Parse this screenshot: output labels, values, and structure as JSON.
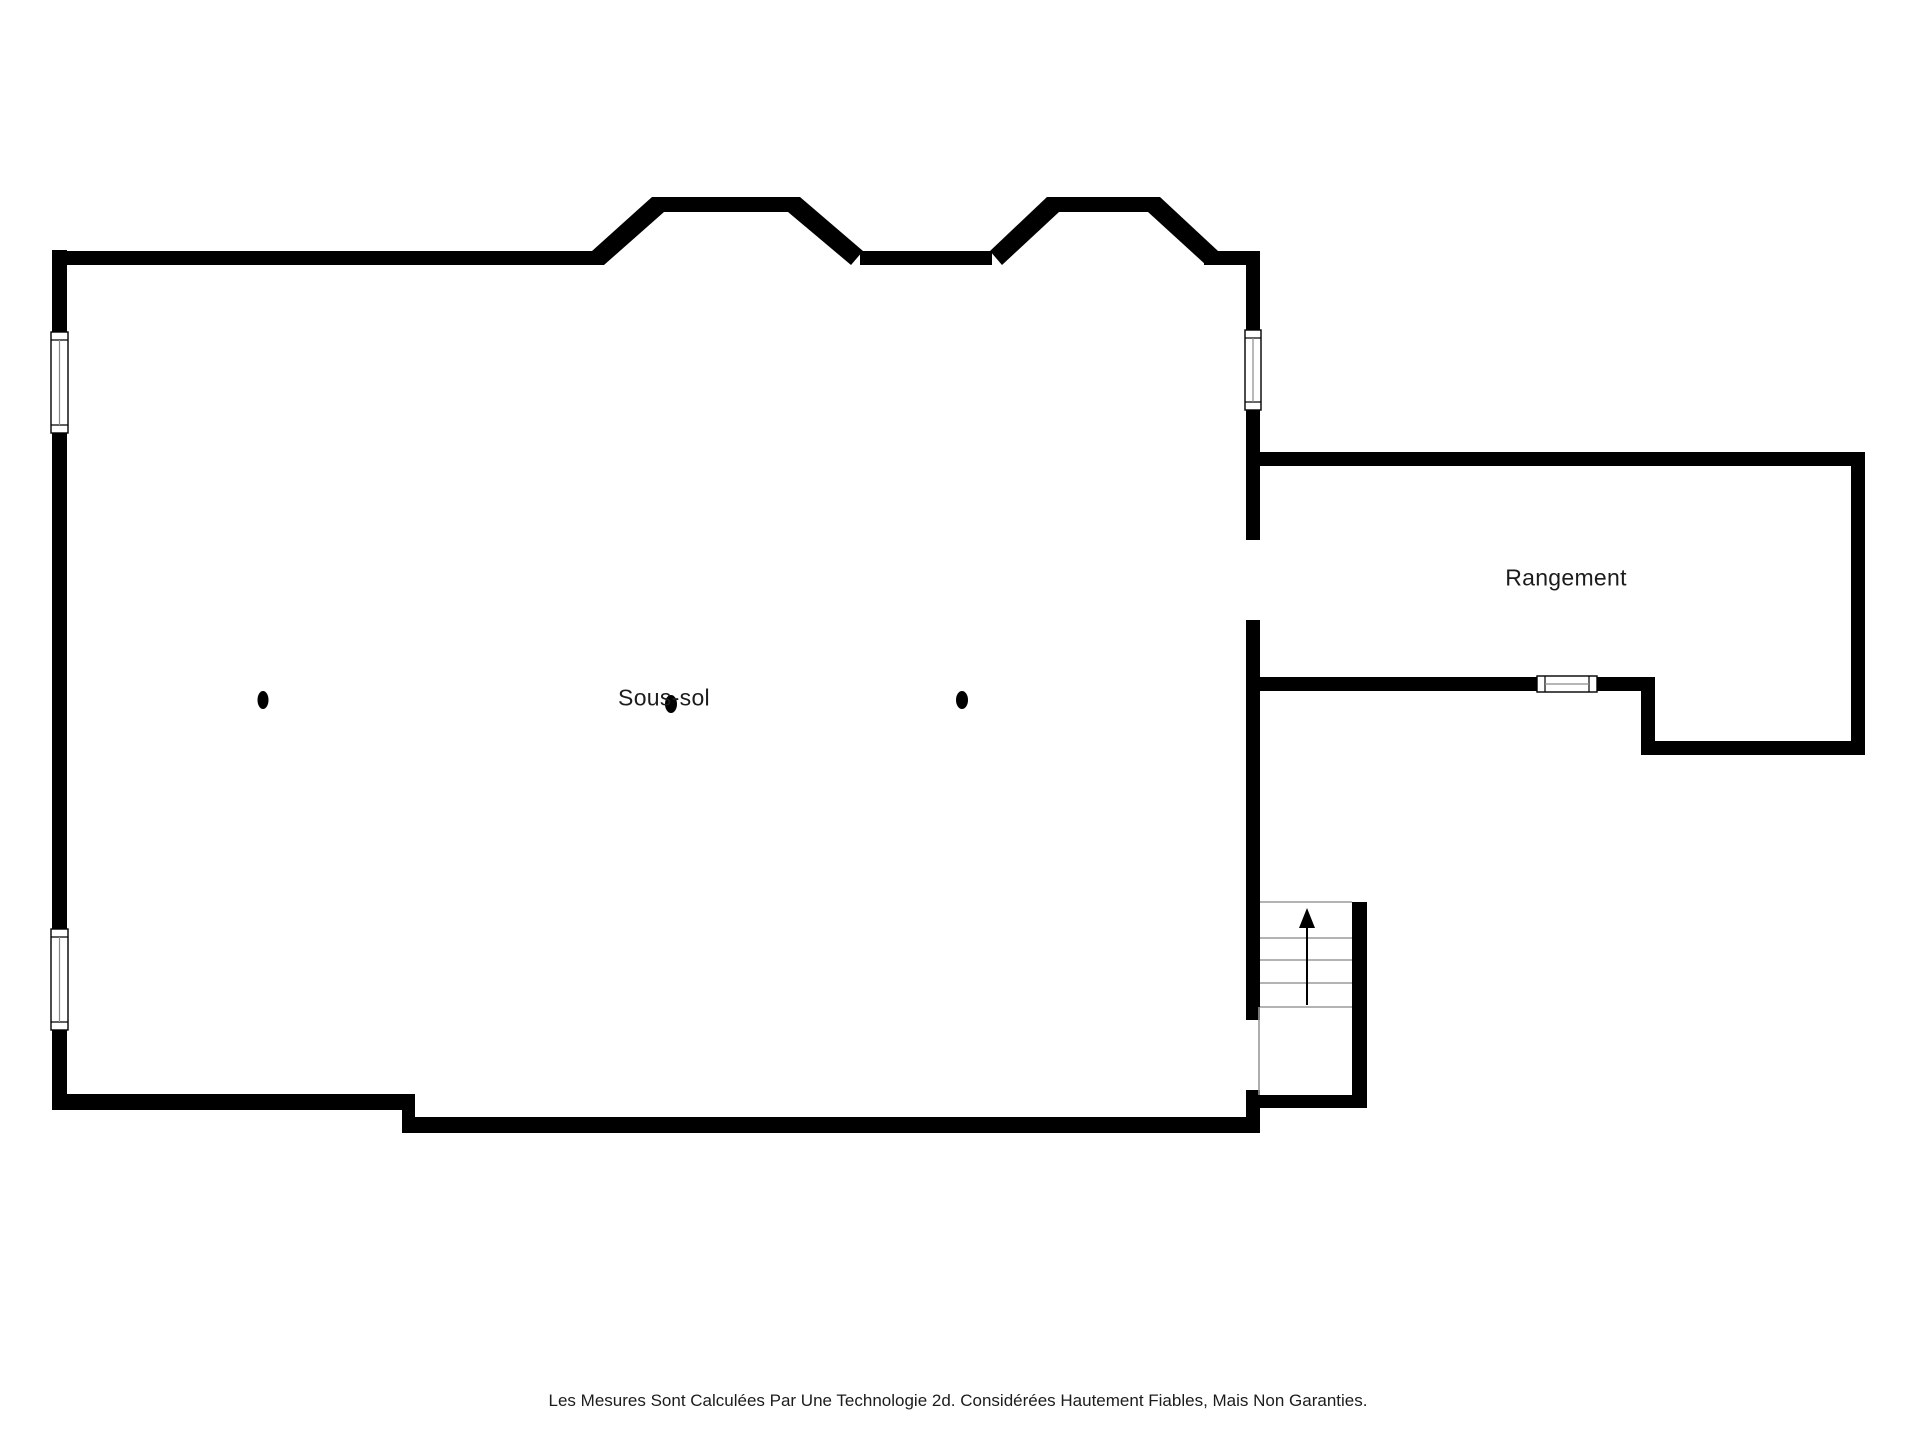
{
  "floorplan": {
    "canvas": {
      "width": 1920,
      "height": 1440
    },
    "colors": {
      "background": "#ffffff",
      "wall": "#000000",
      "thin_line": "#9a9a9a",
      "window_frame": "#000000",
      "window_mullion": "#8a8a8a",
      "text": "#1c1c1c"
    },
    "rooms": [
      {
        "id": "sous_sol",
        "label": "Sous-sol",
        "label_x": 664,
        "label_y": 698
      },
      {
        "id": "rangement",
        "label": "Rangement",
        "label_x": 1566,
        "label_y": 578
      }
    ],
    "footer": {
      "text": "Les Mesures Sont Calculées Par Une Technologie 2d. Considérées Hautement Fiables, Mais Non Garanties.",
      "x": 958,
      "y": 1401
    },
    "walls_rects": [
      {
        "name": "left-wall",
        "x": 52,
        "y": 250,
        "w": 15,
        "h": 860
      },
      {
        "name": "top-wall-west",
        "x": 52,
        "y": 251,
        "w": 552,
        "h": 14
      },
      {
        "name": "bay1-top-wall",
        "x": 652,
        "y": 197,
        "w": 148,
        "h": 15
      },
      {
        "name": "top-wall-mid",
        "x": 860,
        "y": 251,
        "w": 132,
        "h": 14
      },
      {
        "name": "bay2-top-wall",
        "x": 1047,
        "y": 197,
        "w": 113,
        "h": 15
      },
      {
        "name": "top-wall-east",
        "x": 1204,
        "y": 251,
        "w": 56,
        "h": 14
      },
      {
        "name": "right-wall-upper",
        "x": 1246,
        "y": 251,
        "w": 14,
        "h": 81
      },
      {
        "name": "right-wall-mid",
        "x": 1246,
        "y": 408,
        "w": 14,
        "h": 132
      },
      {
        "name": "right-wall-lower",
        "x": 1246,
        "y": 620,
        "w": 14,
        "h": 400
      },
      {
        "name": "right-wall-foot",
        "x": 1246,
        "y": 1090,
        "w": 14,
        "h": 43
      },
      {
        "name": "bottom-wall-center",
        "x": 402,
        "y": 1117,
        "w": 858,
        "h": 16
      },
      {
        "name": "bottom-wall-left",
        "x": 52,
        "y": 1094,
        "w": 363,
        "h": 16
      },
      {
        "name": "bottom-wall-step",
        "x": 402,
        "y": 1094,
        "w": 13,
        "h": 30
      },
      {
        "name": "rangement-top-wall",
        "x": 1246,
        "y": 452,
        "w": 619,
        "h": 14
      },
      {
        "name": "rangement-right-wall",
        "x": 1851,
        "y": 452,
        "w": 14,
        "h": 303
      },
      {
        "name": "rangement-bottom-lower",
        "x": 1641,
        "y": 741,
        "w": 224,
        "h": 14
      },
      {
        "name": "rangement-step-wall",
        "x": 1641,
        "y": 677,
        "w": 14,
        "h": 72
      },
      {
        "name": "rangement-bottom-upper",
        "x": 1246,
        "y": 677,
        "w": 409,
        "h": 14
      },
      {
        "name": "stair-right-wall",
        "x": 1352,
        "y": 902,
        "w": 15,
        "h": 205
      },
      {
        "name": "stair-bottom-wall",
        "x": 1260,
        "y": 1095,
        "w": 107,
        "h": 13
      }
    ],
    "walls_polygons": [
      {
        "name": "bay1-rise-wall",
        "points": "592,251 652,197 664,212 604,265"
      },
      {
        "name": "bay1-fall-wall",
        "points": "788,212 800,197 863,251 851,265"
      },
      {
        "name": "bay2-rise-wall",
        "points": "990,251 1047,197 1059,212 1002,265"
      },
      {
        "name": "bay2-fall-wall",
        "points": "1148,212 1160,197 1218,251 1206,265"
      }
    ],
    "windows": [
      {
        "name": "left-window-upper",
        "orient": "v",
        "x": 51,
        "y": 332,
        "w": 17,
        "h": 101
      },
      {
        "name": "left-window-lower",
        "orient": "v",
        "x": 51,
        "y": 929,
        "w": 17,
        "h": 101
      },
      {
        "name": "right-window-upper",
        "orient": "v",
        "x": 1245,
        "y": 330,
        "w": 16,
        "h": 80
      },
      {
        "name": "rangement-window",
        "orient": "h",
        "x": 1537,
        "y": 676,
        "w": 60,
        "h": 16
      }
    ],
    "stairs": {
      "thin_lines": [
        {
          "name": "stair-top-edge",
          "x1": 1260,
          "y1": 902,
          "x2": 1352,
          "y2": 902
        },
        {
          "name": "stair-tread-1",
          "x1": 1260,
          "y1": 938,
          "x2": 1352,
          "y2": 938
        },
        {
          "name": "stair-tread-2",
          "x1": 1260,
          "y1": 960,
          "x2": 1352,
          "y2": 960
        },
        {
          "name": "stair-tread-3",
          "x1": 1260,
          "y1": 983,
          "x2": 1352,
          "y2": 983
        },
        {
          "name": "stair-tread-4",
          "x1": 1260,
          "y1": 1007,
          "x2": 1352,
          "y2": 1007
        },
        {
          "name": "stair-west-edge",
          "x1": 1259,
          "y1": 1007,
          "x2": 1259,
          "y2": 1095
        }
      ],
      "arrow": {
        "name": "stair-up-arrow",
        "line": {
          "x1": 1307,
          "y1": 1005,
          "x2": 1307,
          "y2": 926
        },
        "head_points": "1307,908 1299,928 1315,928"
      }
    },
    "columns": [
      {
        "name": "support-post-left",
        "cx": 263,
        "cy": 700,
        "rx": 5.5,
        "ry": 9
      },
      {
        "name": "support-post-center",
        "cx": 671,
        "cy": 704,
        "rx": 6,
        "ry": 9
      },
      {
        "name": "support-post-right",
        "cx": 962,
        "cy": 700,
        "rx": 6,
        "ry": 9
      }
    ]
  }
}
